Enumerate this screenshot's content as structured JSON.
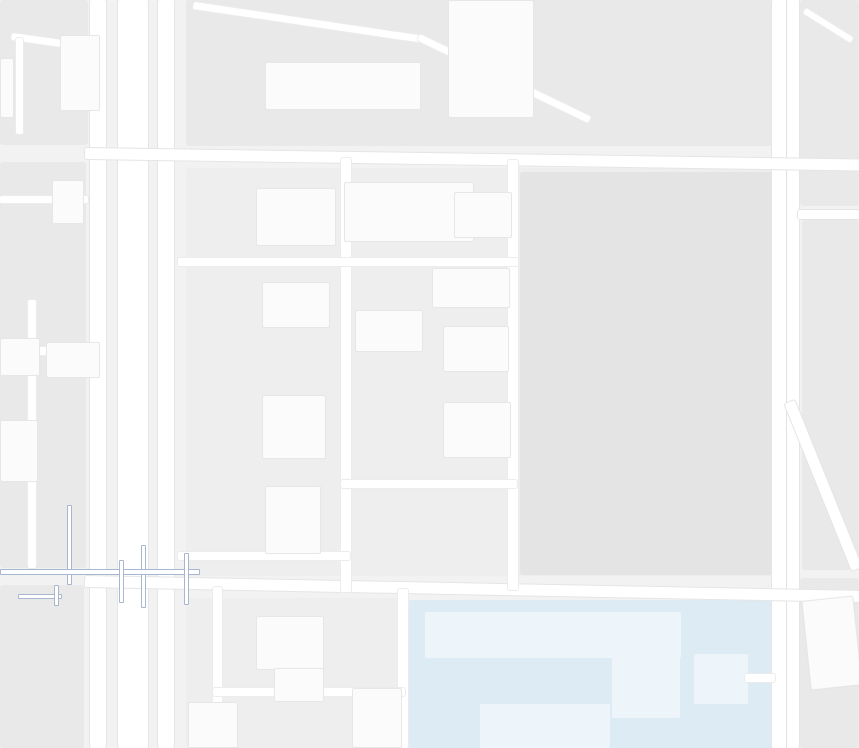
{
  "app": {
    "title": "地图 - 合肥金融港区域"
  },
  "colors": {
    "bg": "#f2f2f2",
    "block": "#e9e9e9",
    "block_dark": "#e4e4e4",
    "block_light": "#eeeeee",
    "building": "#fbfbfb",
    "campus": "#dcebf4",
    "campus_building": "#edf5fa",
    "road": "#ffffff",
    "overpass": "#a9b6cf",
    "text": {
      "purple": "#9a5fc9",
      "orange": "#ff7333",
      "navy": "#2b3c58",
      "blue": "#3e5f9e",
      "teal": "#2fa8bd",
      "red": "#cf4136",
      "gray": "#b3b3b7",
      "gray_big": "#aaaaae",
      "slab_gray": "#a6b1b9",
      "campus_gray": "#8f9aa3",
      "road_gray": "#62666b"
    },
    "icon": {
      "purple": "#a76cd6",
      "orange": "#ff8547",
      "teal": "#41bdd6",
      "cyan": "#35b8cb",
      "blue": "#2b9df4",
      "lightblue": "#4ab6dc",
      "gold": "#f3bb50",
      "marker_red": "#e6392e",
      "marker_stem": "#9c2117",
      "tl_red": "#ff5a4d",
      "tl_orange": "#f5a623",
      "tl_green": "#7ac943"
    },
    "parking_label": "P",
    "arrow_glyphs": {
      "up": "↑",
      "down": "↓",
      "left": "←",
      "right": "→"
    },
    "road_labels_h": [
      {
        "id": "yangzijiang-road-west",
        "text": "扬子江路",
        "x": 294,
        "y": 147,
        "rot": -4
      },
      {
        "id": "yangzijiang-road-east",
        "text": "扬子江路",
        "x": 658,
        "y": 151,
        "rot": 2
      },
      {
        "id": "nanjing-road-west",
        "text": "南京路",
        "x": 343,
        "y": 569,
        "rot": -7
      },
      {
        "id": "nanjing-road-east",
        "text": "南京路",
        "x": 655,
        "y": 583,
        "rot": 7
      }
    ],
    "road_labels_v": [
      {
        "id": "huizhou-fulu-top",
        "text": "徽州大道辅路",
        "x": 159,
        "y": -28
      },
      {
        "id": "huizhou-avenue-mid",
        "text": "徽州大道",
        "x": 133,
        "y": 310
      },
      {
        "id": "huizhou-fulu-mid-east",
        "text": "徽州大道辅路",
        "x": 157,
        "y": 395
      },
      {
        "id": "huizhou-fulu-mid-west",
        "text": "徽州大道辅路",
        "x": 96,
        "y": 444
      },
      {
        "id": "huizhou-avenue-bottom",
        "text": "徽州大道",
        "x": 131,
        "y": 675
      },
      {
        "id": "huizhou-fulu-bottom-west",
        "text": "徽州大道辅路",
        "x": 97,
        "y": 676
      },
      {
        "id": "huizhou-fulu-bottom-east",
        "text": "徽州大道辅路",
        "x": 163,
        "y": 640
      },
      {
        "id": "guangxi-road-top",
        "text": "广西路",
        "x": 775,
        "y": 313
      },
      {
        "id": "guangxi-road-bottom",
        "text": "广西路",
        "x": 779,
        "y": 686
      }
    ],
    "building_labels": [
      {
        "id": "bldg-a5",
        "text": "A5栋",
        "x": 352,
        "y": 220,
        "color": "gray"
      },
      {
        "id": "bldg-a6",
        "text": "A6栋",
        "x": 482,
        "y": 215,
        "color": "gray"
      },
      {
        "id": "bldg-a3",
        "text": "A3栋",
        "x": 247,
        "y": 324,
        "color": "gray"
      },
      {
        "id": "bldg-a12",
        "text": "A12幢",
        "x": 358,
        "y": 398,
        "color": "gray"
      },
      {
        "id": "area-hefei-jinronggang",
        "text": "合肥金融港",
        "x": 316,
        "y": 366,
        "color": "gray_big",
        "fs": 15
      },
      {
        "id": "bldg-b12",
        "text": "合肥金融港B12栋",
        "x": 616,
        "y": 463,
        "color": "slab_gray"
      },
      {
        "id": "bldg-b13",
        "text": "B13栋",
        "x": 662,
        "y": 496,
        "color": "slab_gray"
      },
      {
        "id": "bldg-azuo",
        "text": "A座",
        "x": 283,
        "y": 636,
        "color": "gray"
      },
      {
        "id": "school-campus-line1",
        "text": "合肥师范",
        "x": 549,
        "y": 678,
        "color": "campus_gray",
        "fs": 13
      },
      {
        "id": "school-campus-line2",
        "text": "附小(二小)",
        "x": 544,
        "y": 694,
        "color": "campus_gray",
        "fs": 13
      }
    ],
    "pois": [
      {
        "name": "laohui-hotel",
        "color": "purple",
        "icon": {
          "type": "bed",
          "color": "purple",
          "x": 10,
          "y": 76
        },
        "lines": [
          {
            "t": "老汇酒店",
            "x": 2,
            "y": 97
          }
        ]
      },
      {
        "name": "anhui-dipu-media-company",
        "color": "blue",
        "icon": {
          "type": "bldg",
          "color": "teal",
          "x": 213,
          "y": 166
        },
        "lines": [
          {
            "t": "安徽迪浦文化",
            "x": 182,
            "y": 184
          },
          {
            "t": "传媒有限公司",
            "x": 182,
            "y": 201
          }
        ]
      },
      {
        "name": "zheshang-bank",
        "color": "navy",
        "icon": {
          "type": "yen",
          "color": "teal",
          "x": 294,
          "y": 203
        },
        "lines": [
          {
            "t": "浙商银行",
            "x": 278,
            "y": 222
          }
        ]
      },
      {
        "name": "guanggu-united-jinronggang-north-gate1",
        "color": "navy",
        "icon": {
          "type": "entrance",
          "color": "lightblue",
          "x": 344,
          "y": 176
        },
        "lines": [
          {
            "t": "光谷联合合肥",
            "x": 362,
            "y": 172
          },
          {
            "t": "金融港-北1门",
            "x": 362,
            "y": 189
          }
        ]
      },
      {
        "name": "7tt-fresh-food-store",
        "color": "purple",
        "icon": {
          "type": "bag",
          "color": "purple",
          "x": 407,
          "y": 244
        },
        "lines": [
          {
            "t": "7TT鲜食便利",
            "x": 333,
            "y": 245
          }
        ]
      },
      {
        "name": "quanpai-food-street",
        "color": "orange",
        "icon": {
          "type": "bowl",
          "color": "orange",
          "x": 435,
          "y": 244
        },
        "lines": [
          {
            "t": "全派食街",
            "x": 457,
            "y": 245
          }
        ]
      },
      {
        "name": "yanzhifang-guwu",
        "color": "purple",
        "icon": {
          "type": "bag",
          "color": "purple",
          "x": 424,
          "y": 268
        },
        "lines": [
          {
            "t": "燕之坊谷屋",
            "x": 354,
            "y": 268
          }
        ]
      },
      {
        "name": "hefei-jinronggang-a",
        "color": "navy",
        "icon": {
          "type": "bldg",
          "color": "teal",
          "x": 389,
          "y": 310
        },
        "lines": [
          {
            "t": "合肥金融港A",
            "x": 362,
            "y": 329
          }
        ]
      },
      {
        "name": "fuyuan-noodle-house",
        "color": "orange",
        "icon": {
          "type": "bowl",
          "color": "orange",
          "x": 408,
          "y": 377
        },
        "lines": [
          {
            "t": "福元面馆",
            "x": 428,
            "y": 378
          }
        ]
      },
      {
        "name": "itea-aicha",
        "color": "orange",
        "icon": {
          "type": "xfork",
          "color": "orange",
          "x": 507,
          "y": 358
        },
        "lines": [
          {
            "t": "ITEA爱茶",
            "x": 528,
            "y": 359
          }
        ]
      },
      {
        "name": "qinhexuan-private-kitchen",
        "color": "orange",
        "icon": {
          "type": "bowl",
          "color": "orange",
          "x": 576,
          "y": 397
        },
        "lines": [
          {
            "t": "沁和轩私厨",
            "x": 551,
            "y": 416
          }
        ]
      },
      {
        "name": "baohequ-binhu-a2-office",
        "color": "blue",
        "icon": {
          "type": "bldg",
          "color": "teal",
          "x": 320,
          "y": 412
        },
        "lines": [
          {
            "t": "包河区滨湖金融港",
            "x": 231,
            "y": 396
          },
          {
            "t": "a2写字楼",
            "x": 271,
            "y": 414
          }
        ]
      },
      {
        "name": "lawson-store",
        "color": "purple",
        "icon": {
          "type": "bag",
          "color": "purple",
          "x": 388,
          "y": 434
        },
        "lines": [
          {
            "t": "罗森便利店",
            "x": 407,
            "y": 435
          }
        ]
      },
      {
        "name": "binhu-a1-office",
        "color": "navy",
        "icon": {
          "type": "bldg",
          "color": "teal",
          "x": 317,
          "y": 494
        },
        "lines": [
          {
            "t": "滨湖金融港",
            "x": 295,
            "y": 514
          },
          {
            "t": "A1写字楼",
            "x": 300,
            "y": 530
          }
        ]
      },
      {
        "name": "mengfan-taekwondo",
        "color": "navy",
        "icon": {
          "type": "person",
          "color": "teal",
          "x": 258,
          "y": 532
        },
        "lines": [
          {
            "t": "梦帆跆拳道",
            "x": 189,
            "y": 533
          }
        ]
      },
      {
        "name": "changran-tobacco-shop",
        "color": "purple",
        "icon": {
          "type": "bag",
          "color": "purple",
          "x": 301,
          "y": 593
        },
        "lines": [
          {
            "t": "畅冉烟酒商店",
            "x": 321,
            "y": 594
          }
        ]
      },
      {
        "name": "hefei-shijian-apartment-hotel",
        "color": "purple",
        "icon": {
          "type": "bed",
          "color": "purple",
          "x": 255,
          "y": 622
        },
        "lines": [
          {
            "t": "合肥拾间",
            "x": 201,
            "y": 614
          },
          {
            "t": "公寓酒店",
            "x": 201,
            "y": 631
          }
        ]
      },
      {
        "name": "benrong-business-hotel",
        "color": "purple",
        "icon": {
          "type": "bed",
          "color": "purple",
          "x": 311,
          "y": 625
        },
        "lines": [
          {
            "t": "本荣商务宾馆",
            "x": 332,
            "y": 626
          }
        ]
      },
      {
        "name": "ende-holiday-hotel",
        "color": "purple",
        "icon": {
          "type": "bed",
          "color": "purple",
          "x": 321,
          "y": 697
        },
        "lines": [
          {
            "t": "恩德假日",
            "x": 342,
            "y": 691
          },
          {
            "t": "商务酒店",
            "x": 342,
            "y": 707
          }
        ]
      },
      {
        "name": "qionglin-b-block",
        "color": "teal",
        "icon": {
          "type": "bldg",
          "color": "cyan",
          "x": 339,
          "y": 730
        },
        "lines": [
          {
            "t": "琼林b座",
            "x": 289,
            "y": 730
          }
        ]
      },
      {
        "name": "hefei-shifan-fuxiao",
        "color": "teal",
        "icon": {
          "type": "leaf",
          "color": "cyan",
          "x": 719,
          "y": 676
        },
        "lines": [
          {
            "t": "合肥师范附小",
            "x": 689,
            "y": 694
          }
        ]
      },
      {
        "name": "dingliyang-flagship",
        "color": "orange",
        "icon": {
          "type": "bowl",
          "color": "orange",
          "x": 836,
          "y": 624
        },
        "lines": [
          {
            "t": "丁里羊",
            "x": 821,
            "y": 644
          },
          {
            "t": "小镇旗舰店",
            "x": 812,
            "y": 660
          }
        ]
      },
      {
        "name": "public-security-bureau",
        "color": "red",
        "icon": {
          "type": "emblem",
          "color": "gold",
          "x": -3,
          "y": 291
        },
        "lines": [
          {
            "t": "公安局",
            "x": 0,
            "y": 309,
            "fs": 14
          },
          {
            "t": "管理局",
            "x": -2,
            "y": 325,
            "fs": 14
          }
        ]
      },
      {
        "name": "merchants-bank",
        "color": "navy",
        "icon": {
          "type": "cmb",
          "color": "white",
          "x": 2,
          "y": 407
        },
        "lines": [
          {
            "t": "商银行",
            "x": 0,
            "y": 429,
            "fs": 14
          }
        ]
      }
    ],
    "parking_icons": [
      {
        "x": 704,
        "y": 129
      },
      {
        "x": 327,
        "y": 279
      },
      {
        "x": 485,
        "y": 314
      },
      {
        "x": 454,
        "y": 487
      },
      {
        "x": 612,
        "y": 610
      }
    ],
    "transit_icons": [
      {
        "name": "metro-station-icon",
        "x": 149,
        "y": 505
      },
      {
        "name": "bus-station-icon",
        "x": 115,
        "y": 635
      }
    ],
    "restaurant_icons": [
      {
        "x": 374,
        "y": 731
      }
    ],
    "traffic_light": {
      "x": 774,
      "y": 155
    },
    "marker": {
      "name": "gate-marker-north1",
      "head_x": 386.5,
      "head_y": 193,
      "stem_x": 390.7,
      "stem_y1": 202,
      "stem_y2": 214,
      "base_x": 380,
      "base_y": 212,
      "dash_x": 386,
      "dash_y": 215.6
    },
    "arrows": [
      {
        "x": 118,
        "y": -3,
        "dir": "down"
      },
      {
        "x": 121,
        "y": 100,
        "dir": "down"
      },
      {
        "x": 149,
        "y": 114,
        "dir": "up"
      },
      {
        "x": 248,
        "y": 143,
        "dir": "left"
      },
      {
        "x": 417,
        "y": 144,
        "dir": "left"
      },
      {
        "x": 432,
        "y": 155,
        "dir": "right"
      },
      {
        "x": 775,
        "y": 26,
        "dir": "down"
      },
      {
        "x": 787,
        "y": 36,
        "dir": "up"
      },
      {
        "x": 783,
        "y": 362,
        "dir": "up"
      },
      {
        "x": 783,
        "y": 467,
        "dir": "up"
      },
      {
        "x": 101,
        "y": 320,
        "dir": "down"
      },
      {
        "x": 122,
        "y": 330,
        "dir": "down"
      },
      {
        "x": 150,
        "y": 327,
        "dir": "up"
      },
      {
        "x": 119,
        "y": 509,
        "dir": "down"
      },
      {
        "x": 147,
        "y": 698,
        "dir": "up"
      },
      {
        "x": 427,
        "y": 581,
        "dir": "right"
      }
    ]
  }
}
